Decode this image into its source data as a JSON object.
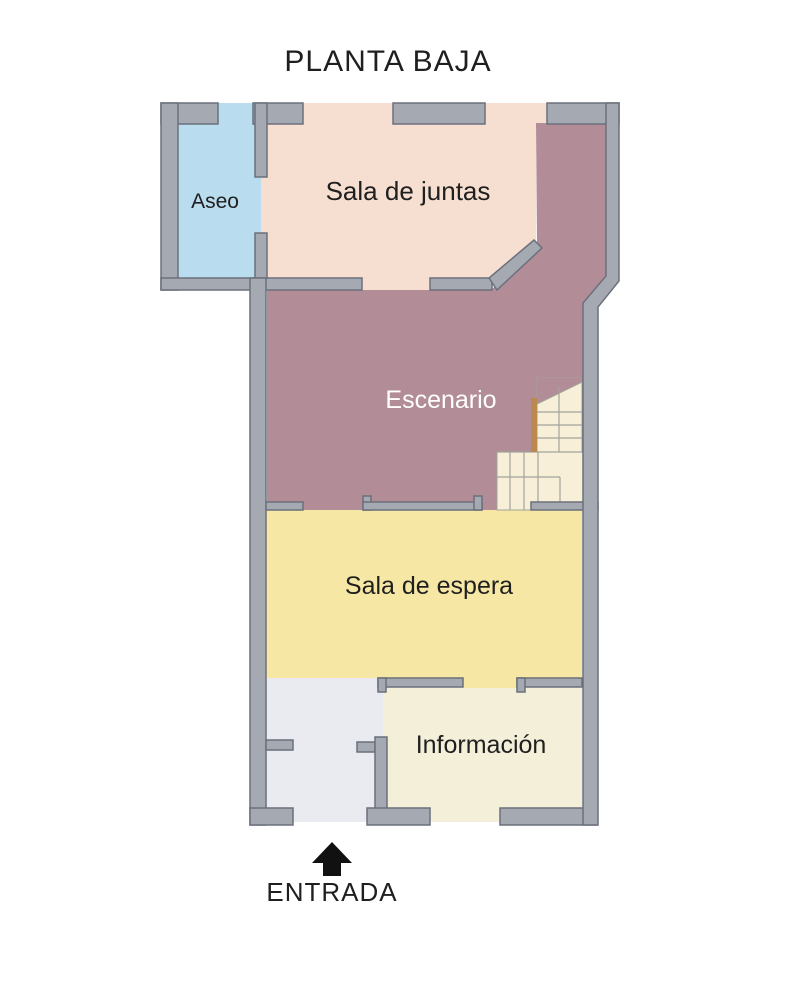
{
  "title": "PLANTA BAJA",
  "entrance": {
    "label": "ENTRADA",
    "arrow_icon": "up-arrow"
  },
  "rooms": [
    {
      "id": "aseo",
      "label": "Aseo",
      "color": "#b9dcee",
      "label_color": "#1f1f1f"
    },
    {
      "id": "sala-de-juntas",
      "label": "Sala de juntas",
      "color": "#f6dfd0",
      "label_color": "#1f1f1f"
    },
    {
      "id": "escenario",
      "label": "Escenario",
      "color": "#b28d97",
      "label_color": "#ffffff"
    },
    {
      "id": "sala-de-espera",
      "label": "Sala de espera",
      "color": "#f6e7a4",
      "label_color": "#1f1f1f"
    },
    {
      "id": "informacion",
      "label": "Información",
      "color": "#f4efd9",
      "label_color": "#1f1f1f"
    },
    {
      "id": "vestibulo",
      "label": "",
      "color": "#e9ebf1",
      "label_color": "#1f1f1f"
    }
  ],
  "colors": {
    "wall_fill": "#a4a9b2",
    "wall_stroke": "#6b707b",
    "stairs_floor": "#f7efd8",
    "stairs_line": "#a3a39b",
    "handrail": "#b9894f",
    "text": "#1f1f1f",
    "arrow": "#111111",
    "background": "#ffffff"
  }
}
